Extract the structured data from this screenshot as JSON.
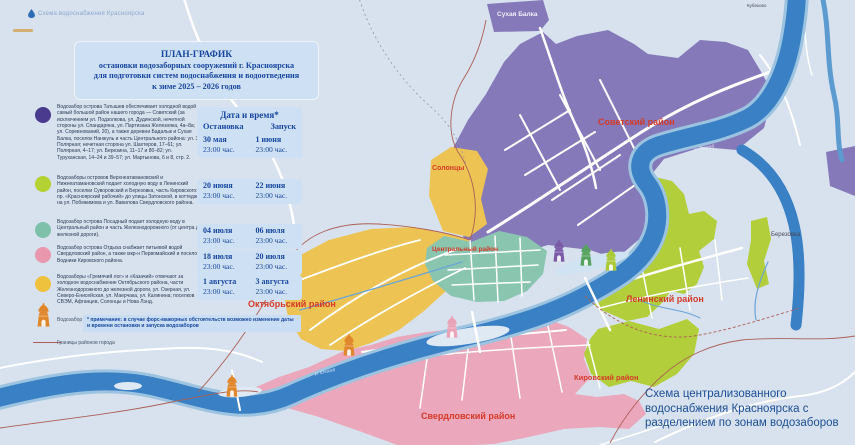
{
  "watermark": {
    "label": "Схема водоснабжения Красноярска"
  },
  "title": {
    "line1": "ПЛАН-ГРАФИК",
    "line2": "остановки водозаборных сооружений г. Красноярска",
    "line3": "для подготовки систем водоснабжения и водоотведения",
    "line4": "к зиме 2025 – 2026 годов"
  },
  "legend": {
    "items": [
      {
        "name": "Водозабор острова Татышев",
        "color": "#4a3b8f",
        "text": "Водозабор острова Татышев обеспечивает холодной водой самый большой район нашего города — Советский (за исключением ул. Подзолкова, ул. Дудинской, нечетной стороны ул. Спандаряна, ул. Партизана Железняка, 4а–8а; ул. Соревнований, 20), а также деревни Бадалык и Сухая Балка, поселок Нанжуль и часть Центрального района: ул. 3-я Полярная; нечетная сторона ул. Шахтеров, 17–61; ул. Полярная, 4–17; ул. Березина, 11–17 и 80–82; ул. Туруханская, 14–24 и 39–57; ул. Мартынова, 6 и 8, стр. 2."
      },
      {
        "name": "Водозаборы островов Верхнеатамановский и Нижнеатамановский",
        "color": "#b5d233",
        "text": "Водозаборы островов Верхнеатамановский и Нижнеатамановский подает холодную воду в Ленинский район, поселки Суворовский и Березовка, часть Кировского: пр. «Красноярский рабочий» до улицы Затонской, в коттеджи на ул. Побежимова и ул. Вавилова Свердловского района."
      },
      {
        "name": "Водозабор острова Посадный",
        "color": "#7fc0ab",
        "text": "Водозабор острова Посадный подает холодную воду в Центральный район и часть Железнодорожного (от центра до железной дороги)."
      },
      {
        "name": "Водозабор острова Отдыха",
        "color": "#e897ad",
        "text": "Водозабор острова Отдыха снабжает питьевой водой Свердловский район, а также мкр-н Первомайский и поселок Водники Кировского района."
      },
      {
        "name": "Водозаборы Гремячий лог и Казачий",
        "color": "#eec23d",
        "text": "Водозаборы «Гремячий лог» и «Казачий» отвечают за холодное водоснабжение Октябрьского района, части Железнодорожного до железной дороги, ул. Озерная, ул. Северо-Енисейская, ул. Маерчака, ул. Калинина; поселков СВЭМ, Афганцев, Солонцы и Нова Лэнд."
      }
    ],
    "intake_label": "Водозабор",
    "borders_label": "Границы районов города"
  },
  "table": {
    "header": "Дата и время*",
    "col_stop": "Остановка",
    "col_start": "Запуск",
    "rows": [
      {
        "stop_date": "30 мая",
        "stop_time": "23:00 час.",
        "start_date": "1 июня",
        "start_time": "23:00 час."
      },
      {
        "stop_date": "20 июня",
        "stop_time": "23:00 час.",
        "start_date": "22 июня",
        "start_time": "23:00 час."
      },
      {
        "stop_date": "04 июля",
        "stop_time": "23:00 час.",
        "start_date": "06 июля",
        "start_time": "23:00 час."
      },
      {
        "stop_date": "18 июля",
        "stop_time": "23:00 час.",
        "start_date": "20 июля",
        "start_time": "23:00 час."
      },
      {
        "stop_date": "1 августа",
        "stop_time": "23:00 час.",
        "start_date": "3 августа",
        "start_time": "23:00 час."
      }
    ]
  },
  "note": "* примечание: в случае форс-мажорных обстоятельств возможно изменение даты и времени остановки и запуска водозаборов",
  "map": {
    "labels": {
      "sukhaya_balka": "Сухая Балка",
      "kubekovo": "Кубеково",
      "sovetsky": "Советский район",
      "solontsy": "Солонцы",
      "tsentralny": "Центральный район",
      "berezovka": "Березовка",
      "leninsky": "Ленинский район",
      "oktyabrsky": "Октябрьский район",
      "kirovsky": "Кировский район",
      "sverdlovsky": "Свердловский район",
      "yenisei": "р. Енисей"
    },
    "caption": "Схема централизованного водоснабжения Красноярска с разделением по зонам водозаборов"
  },
  "colors": {
    "zone_sovetsky_purple": "#8579b9",
    "zone_leninsky_green": "#b2cf3b",
    "zone_tsentralny_teal": "#8ac5b0",
    "zone_sverdlovsky_pink": "#eba7bc",
    "zone_oktyabrsky_yellow": "#edc353",
    "river_blue": "#3a80c4",
    "district_label_red": "#d43a28",
    "panel_blue": "#cde0f4",
    "dark_blue_text": "#17469e",
    "district_border": "#ad5f55",
    "intake_orange": "#e0862b"
  }
}
